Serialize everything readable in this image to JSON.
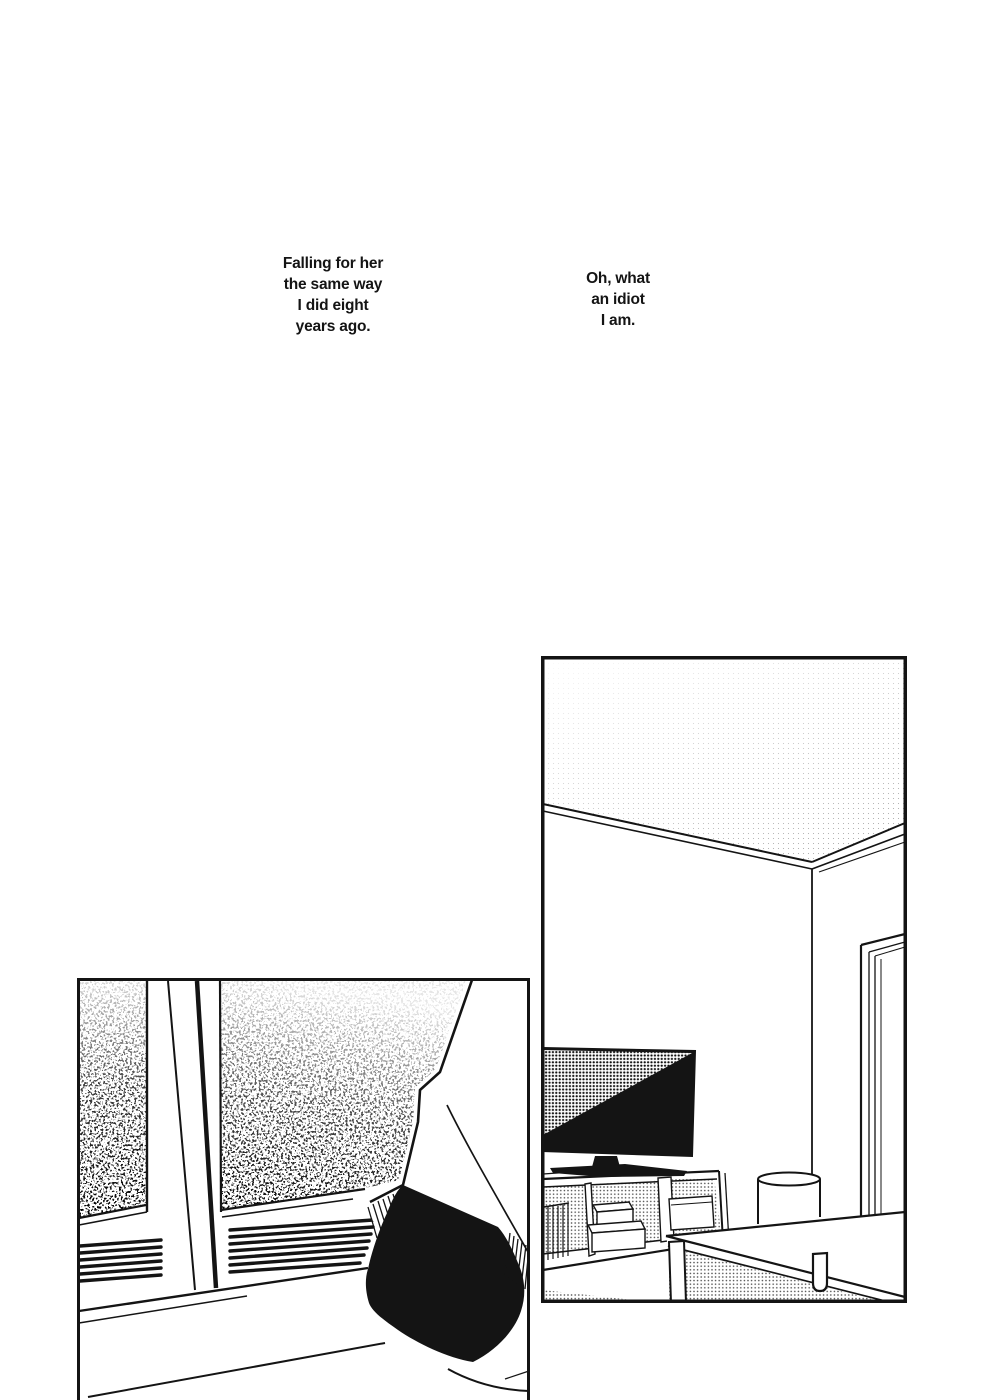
{
  "page": {
    "paper_color": "#ffffff",
    "ink_color": "#141414"
  },
  "captions": [
    {
      "id": "caption-1",
      "lines": [
        "Falling for her",
        "the same way",
        "I did eight",
        "years ago."
      ]
    },
    {
      "id": "caption-2",
      "lines": [
        "Oh, what",
        "an idiot",
        "I am."
      ]
    }
  ],
  "panels": [
    {
      "id": "panel-window-figure",
      "description": "frosted window, vents, figure in white top and dark skirt"
    },
    {
      "id": "panel-living-room",
      "description": "room corner with TV on cabinet, bin and low table"
    }
  ]
}
